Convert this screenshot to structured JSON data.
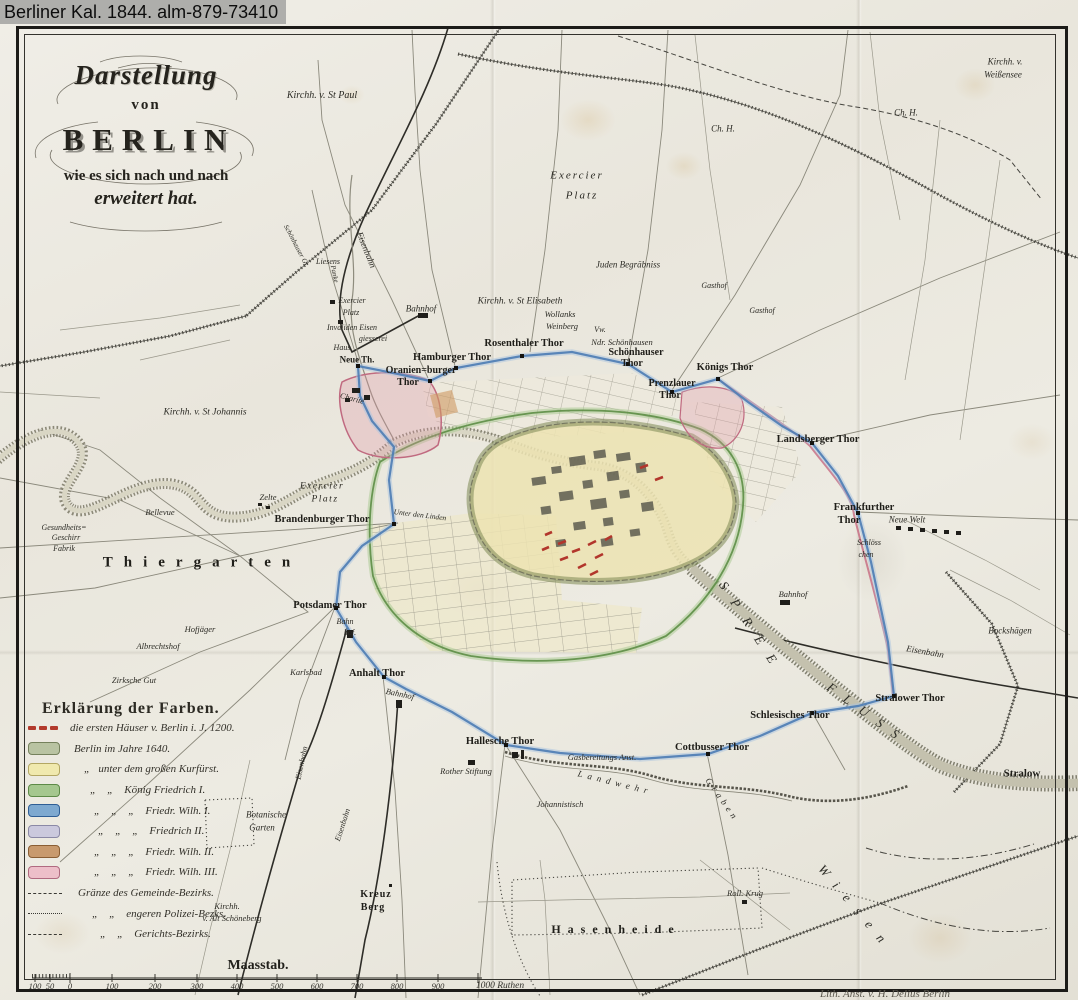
{
  "watermark": "Berliner Kal. 1844. alm-879-73410",
  "title": {
    "line1": "Darstellung",
    "line2": "von",
    "line3": "BERLIN",
    "line4": "wie es sich nach und nach",
    "line5": "erweitert hat."
  },
  "legend": {
    "heading": "Erklärung der Farben.",
    "entries": [
      {
        "type": "dashes",
        "color": "#b23a2c",
        "border": "#7e2418",
        "label": "die ersten Häuser v. Berlin i. J. 1200.",
        "indent": 2
      },
      {
        "type": "box",
        "color": "#b9c3a2",
        "border": "#75815c",
        "label": "Berlin im Jahre 1640.",
        "indent": 6
      },
      {
        "type": "box",
        "color": "#f0e9ae",
        "border": "#b3a763",
        "label": "„   unter dem großen Kurfürst.",
        "indent": 16
      },
      {
        "type": "box",
        "color": "#a5c78e",
        "border": "#5d8a47",
        "label": "„    „    König Friedrich I.",
        "indent": 22
      },
      {
        "type": "box",
        "color": "#7ea9d0",
        "border": "#2f5e95",
        "label": "„    „    „    Friedr. Wilh. I.",
        "indent": 26
      },
      {
        "type": "box",
        "color": "#cbc9dd",
        "border": "#8b89a6",
        "label": "„    „    „    Friedrich II.",
        "indent": 30
      },
      {
        "type": "box",
        "color": "#c89a6e",
        "border": "#8a5e34",
        "label": "„    „    „    Friedr. Wilh. II.",
        "indent": 26
      },
      {
        "type": "box",
        "color": "#edbfc9",
        "border": "#b06a80",
        "label": "„    „    „    Friedr. Wilh. III.",
        "indent": 26
      },
      {
        "type": "line-dashed",
        "color": "#3a3934",
        "border": "#3a3934",
        "label": "Gränze des Gemeinde-Bezirks.",
        "indent": 10
      },
      {
        "type": "line-dotted",
        "color": "#3a3934",
        "border": "#3a3934",
        "label": "„    „    engeren Polizei-Bezks.",
        "indent": 24
      },
      {
        "type": "line-dashdot",
        "color": "#3a3934",
        "border": "#3a3934",
        "label": "„    „    Gerichts-Bezirks.",
        "indent": 32
      }
    ]
  },
  "scalebar": {
    "title": "Maasstab.",
    "ticks": [
      "100",
      "50",
      "0",
      "100",
      "200",
      "300",
      "400",
      "500",
      "600",
      "700",
      "800",
      "900"
    ],
    "unit": "1000 Ruthen"
  },
  "imprint": "Lith. Anst. v. H. Delius Berlin",
  "map_labels": [
    {
      "t": "Kirchh. v. St Paul",
      "x": 322,
      "y": 96,
      "s": 10
    },
    {
      "t": "Kirchh. v.",
      "x": 1005,
      "y": 62,
      "s": 9
    },
    {
      "t": "Weißensee",
      "x": 1003,
      "y": 75,
      "s": 9
    },
    {
      "t": "Ch. H.",
      "x": 723,
      "y": 129,
      "s": 9
    },
    {
      "t": "Ch. H.",
      "x": 906,
      "y": 113,
      "s": 9
    },
    {
      "t": "Exercier",
      "x": 577,
      "y": 176,
      "s": 11,
      "sp": 2
    },
    {
      "t": "Platz",
      "x": 582,
      "y": 196,
      "s": 11,
      "sp": 2
    },
    {
      "t": "Juden Begräbniss",
      "x": 628,
      "y": 265,
      "s": 9
    },
    {
      "t": "Gasthof",
      "x": 714,
      "y": 286,
      "s": 8
    },
    {
      "t": "Gasthof",
      "x": 762,
      "y": 311,
      "s": 8
    },
    {
      "t": "Eisenbahn",
      "x": 366,
      "y": 250,
      "s": 9,
      "r": 68
    },
    {
      "t": "Liesens",
      "x": 328,
      "y": 262,
      "s": 8
    },
    {
      "t": "Schönhauser Gr.",
      "x": 296,
      "y": 246,
      "s": 7,
      "r": 62
    },
    {
      "t": "Panke",
      "x": 334,
      "y": 274,
      "s": 7,
      "r": 78
    },
    {
      "t": "Exercier",
      "x": 352,
      "y": 301,
      "s": 8
    },
    {
      "t": "Platz",
      "x": 351,
      "y": 313,
      "s": 8
    },
    {
      "t": "Invaliden Eisen",
      "x": 352,
      "y": 328,
      "s": 8
    },
    {
      "t": "giesserei",
      "x": 373,
      "y": 339,
      "s": 8
    },
    {
      "t": "Haus",
      "x": 342,
      "y": 348,
      "s": 8
    },
    {
      "t": "Bahnhof",
      "x": 421,
      "y": 309,
      "s": 9
    },
    {
      "t": "Kirchh. v. St Elisabeth",
      "x": 520,
      "y": 302,
      "s": 9.5
    },
    {
      "t": "Wollanks",
      "x": 560,
      "y": 314,
      "s": 8.5
    },
    {
      "t": "Weinberg",
      "x": 562,
      "y": 326,
      "s": 8.5
    },
    {
      "t": "Vw.",
      "x": 600,
      "y": 330,
      "s": 8
    },
    {
      "t": "Ndr. Schönhausen",
      "x": 622,
      "y": 342,
      "s": 8.5
    },
    {
      "t": "Rosenthaler Thor",
      "x": 524,
      "y": 344,
      "s": 10.5,
      "b": 1
    },
    {
      "t": "Hamburger Thor",
      "x": 452,
      "y": 358,
      "s": 10.5,
      "b": 1
    },
    {
      "t": "Schönhauser",
      "x": 636,
      "y": 353,
      "s": 10,
      "b": 1
    },
    {
      "t": "Thor",
      "x": 632,
      "y": 364,
      "s": 10,
      "b": 1
    },
    {
      "t": "Neue Th.",
      "x": 357,
      "y": 360,
      "s": 9,
      "b": 1
    },
    {
      "t": "Oranien=burger",
      "x": 421,
      "y": 371,
      "s": 10,
      "b": 1
    },
    {
      "t": "Thor",
      "x": 408,
      "y": 383,
      "s": 10,
      "b": 1
    },
    {
      "t": "Prenzlauer",
      "x": 672,
      "y": 384,
      "s": 10,
      "b": 1
    },
    {
      "t": "Thor",
      "x": 670,
      "y": 396,
      "s": 10,
      "b": 1
    },
    {
      "t": "Königs Thor",
      "x": 725,
      "y": 368,
      "s": 10.5,
      "b": 1
    },
    {
      "t": "Charité",
      "x": 352,
      "y": 399,
      "s": 8,
      "r": 15
    },
    {
      "t": "Kirchh. v. St Johannis",
      "x": 205,
      "y": 413,
      "s": 9.5
    },
    {
      "t": "Landsberger Thor",
      "x": 818,
      "y": 440,
      "s": 10.5,
      "b": 1
    },
    {
      "t": "Frankfurther",
      "x": 864,
      "y": 508,
      "s": 10.5,
      "b": 1
    },
    {
      "t": "Thor",
      "x": 849,
      "y": 521,
      "s": 10.5,
      "b": 1
    },
    {
      "t": "Neue Welt",
      "x": 907,
      "y": 520,
      "s": 9
    },
    {
      "t": "Schlöss",
      "x": 869,
      "y": 543,
      "s": 8
    },
    {
      "t": "chen",
      "x": 866,
      "y": 555,
      "s": 8
    },
    {
      "t": "Bockshägen",
      "x": 1010,
      "y": 631,
      "s": 9
    },
    {
      "t": "Eisenbahn",
      "x": 925,
      "y": 652,
      "s": 9,
      "r": 10
    },
    {
      "t": "Stralower Thor",
      "x": 910,
      "y": 699,
      "s": 10.5,
      "b": 1
    },
    {
      "t": "Schlesisches Thor",
      "x": 790,
      "y": 716,
      "s": 10.5,
      "b": 1
    },
    {
      "t": "Cottbusser Thor",
      "x": 712,
      "y": 748,
      "s": 10.5,
      "b": 1
    },
    {
      "t": "Stralow",
      "x": 1022,
      "y": 774,
      "s": 11,
      "b": 1
    },
    {
      "t": "Bahnhof",
      "x": 793,
      "y": 594,
      "s": 8.5
    },
    {
      "t": "SPREE",
      "x": 752,
      "y": 628,
      "s": 13,
      "r": 57,
      "sp": 14
    },
    {
      "t": "FLUSS",
      "x": 868,
      "y": 714,
      "s": 13,
      "r": 36,
      "sp": 12
    },
    {
      "t": "Hallesche Thor",
      "x": 500,
      "y": 742,
      "s": 10.5,
      "b": 1
    },
    {
      "t": "Rother Stiftung",
      "x": 466,
      "y": 771,
      "s": 8.5
    },
    {
      "t": "Gasbereitungs Anst.",
      "x": 602,
      "y": 757,
      "s": 8.5
    },
    {
      "t": "Johannistisch",
      "x": 560,
      "y": 804,
      "s": 8.5
    },
    {
      "t": "Landwehr",
      "x": 615,
      "y": 783,
      "s": 9,
      "r": 14,
      "sp": 5
    },
    {
      "t": "Graben",
      "x": 722,
      "y": 800,
      "s": 9,
      "r": 55,
      "sp": 4
    },
    {
      "t": "Botanische",
      "x": 266,
      "y": 815,
      "s": 9
    },
    {
      "t": "Garten",
      "x": 262,
      "y": 828,
      "s": 9
    },
    {
      "t": "Eisenbahn",
      "x": 302,
      "y": 763,
      "s": 8,
      "r": -78
    },
    {
      "t": "Eisenbahn",
      "x": 343,
      "y": 825,
      "s": 8,
      "r": -72
    },
    {
      "t": "Kirchh.",
      "x": 227,
      "y": 906,
      "s": 8.5
    },
    {
      "t": "v. Alt Schöneberg",
      "x": 232,
      "y": 918,
      "s": 8.5
    },
    {
      "t": "Kreuz",
      "x": 376,
      "y": 895,
      "s": 10,
      "b": 1,
      "sp": 1
    },
    {
      "t": "Berg",
      "x": 373,
      "y": 908,
      "s": 10,
      "b": 1,
      "sp": 1
    },
    {
      "t": "Hasenheide",
      "x": 616,
      "y": 929,
      "s": 12,
      "b": 1,
      "sp": 7
    },
    {
      "t": "Roll. Krug",
      "x": 745,
      "y": 893,
      "s": 8.5
    },
    {
      "t": "Wiesen",
      "x": 856,
      "y": 908,
      "s": 13,
      "r": 50,
      "sp": 12
    },
    {
      "t": "Thiergarten",
      "x": 202,
      "y": 563,
      "s": 15,
      "b": 1,
      "sp": 11
    },
    {
      "t": "Zelte",
      "x": 268,
      "y": 497,
      "s": 8.5
    },
    {
      "t": "Exercier",
      "x": 322,
      "y": 487,
      "s": 9.5,
      "sp": 1.5
    },
    {
      "t": "Platz",
      "x": 325,
      "y": 500,
      "s": 9.5,
      "sp": 1.5
    },
    {
      "t": "Bellevue",
      "x": 160,
      "y": 512,
      "s": 8.5
    },
    {
      "t": "Gesundheits=",
      "x": 64,
      "y": 528,
      "s": 8
    },
    {
      "t": "Geschirr",
      "x": 66,
      "y": 538,
      "s": 8
    },
    {
      "t": "Fabrik",
      "x": 64,
      "y": 549,
      "s": 8
    },
    {
      "t": "Brandenburger Thor",
      "x": 322,
      "y": 520,
      "s": 10.5,
      "b": 1
    },
    {
      "t": "Unter den Linden",
      "x": 420,
      "y": 515,
      "s": 7.5,
      "r": 7
    },
    {
      "t": "Potsdamer Thor",
      "x": 330,
      "y": 606,
      "s": 10.5,
      "b": 1
    },
    {
      "t": "Bahn",
      "x": 345,
      "y": 622,
      "s": 8
    },
    {
      "t": "hof.",
      "x": 350,
      "y": 633,
      "s": 8
    },
    {
      "t": "Hofjäger",
      "x": 200,
      "y": 629,
      "s": 8.5
    },
    {
      "t": "Albrechtshof",
      "x": 158,
      "y": 646,
      "s": 8.5
    },
    {
      "t": "Zirksche Gut",
      "x": 134,
      "y": 680,
      "s": 8.5
    },
    {
      "t": "Karlsbad",
      "x": 306,
      "y": 672,
      "s": 8.5
    },
    {
      "t": "Anhalt Thor",
      "x": 377,
      "y": 674,
      "s": 10.5,
      "b": 1
    },
    {
      "t": "Bahnhof",
      "x": 400,
      "y": 694,
      "s": 8.5,
      "r": 12
    }
  ]
}
